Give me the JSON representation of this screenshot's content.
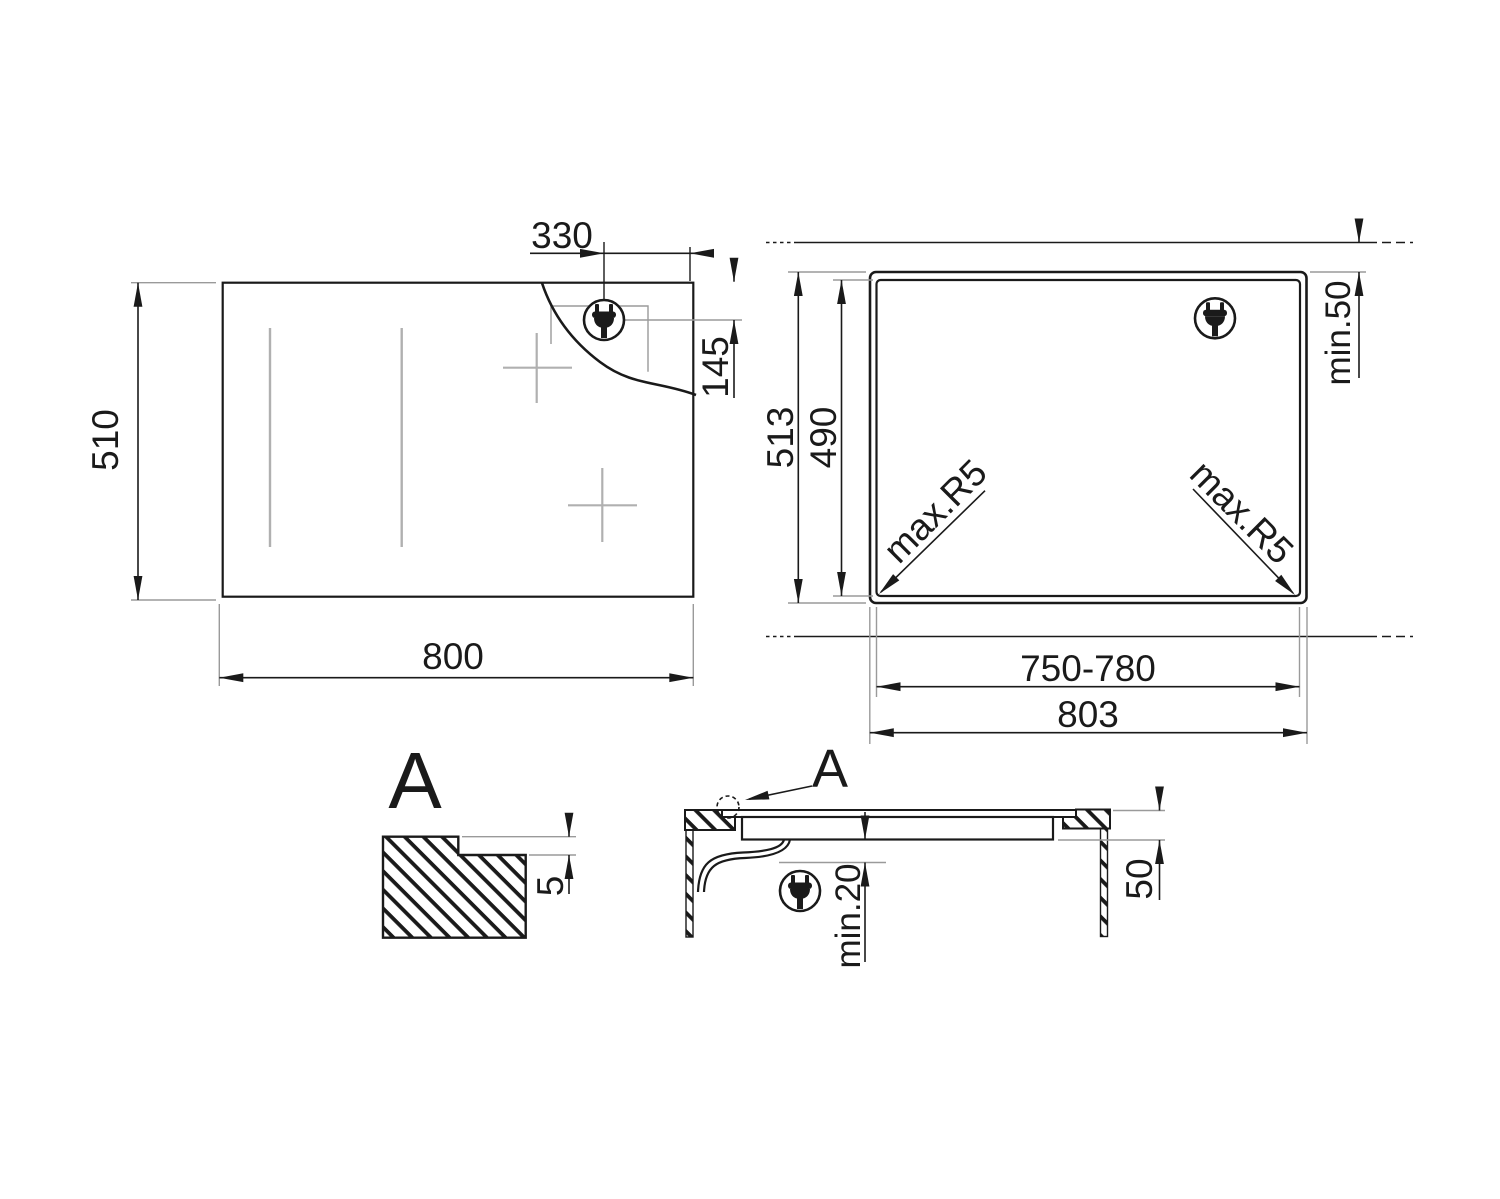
{
  "hob_top_view": {
    "dims": {
      "plug_offset_x": "330",
      "plug_offset_y": "145",
      "height": "510",
      "width": "800"
    }
  },
  "cutout_view": {
    "dims": {
      "outer_height": "513",
      "cutout_height": "490",
      "rear_clearance": "min.50",
      "corner_radius_left": "max.R5",
      "corner_radius_right": "max.R5",
      "cutout_width": "750-780",
      "outer_width": "803"
    }
  },
  "detail_view": {
    "label": "A",
    "dims": {
      "rebate_depth": "5"
    }
  },
  "section_view": {
    "label": "A",
    "dims": {
      "bottom_clearance": "min.20",
      "recess_depth": "50"
    }
  },
  "icons": {
    "power_plug": "power-plug-icon"
  },
  "colors": {
    "line": "#1a1a1a",
    "extension_line": "#9a9a9a",
    "zone_marking": "#b0b0b0",
    "background": "#ffffff"
  }
}
